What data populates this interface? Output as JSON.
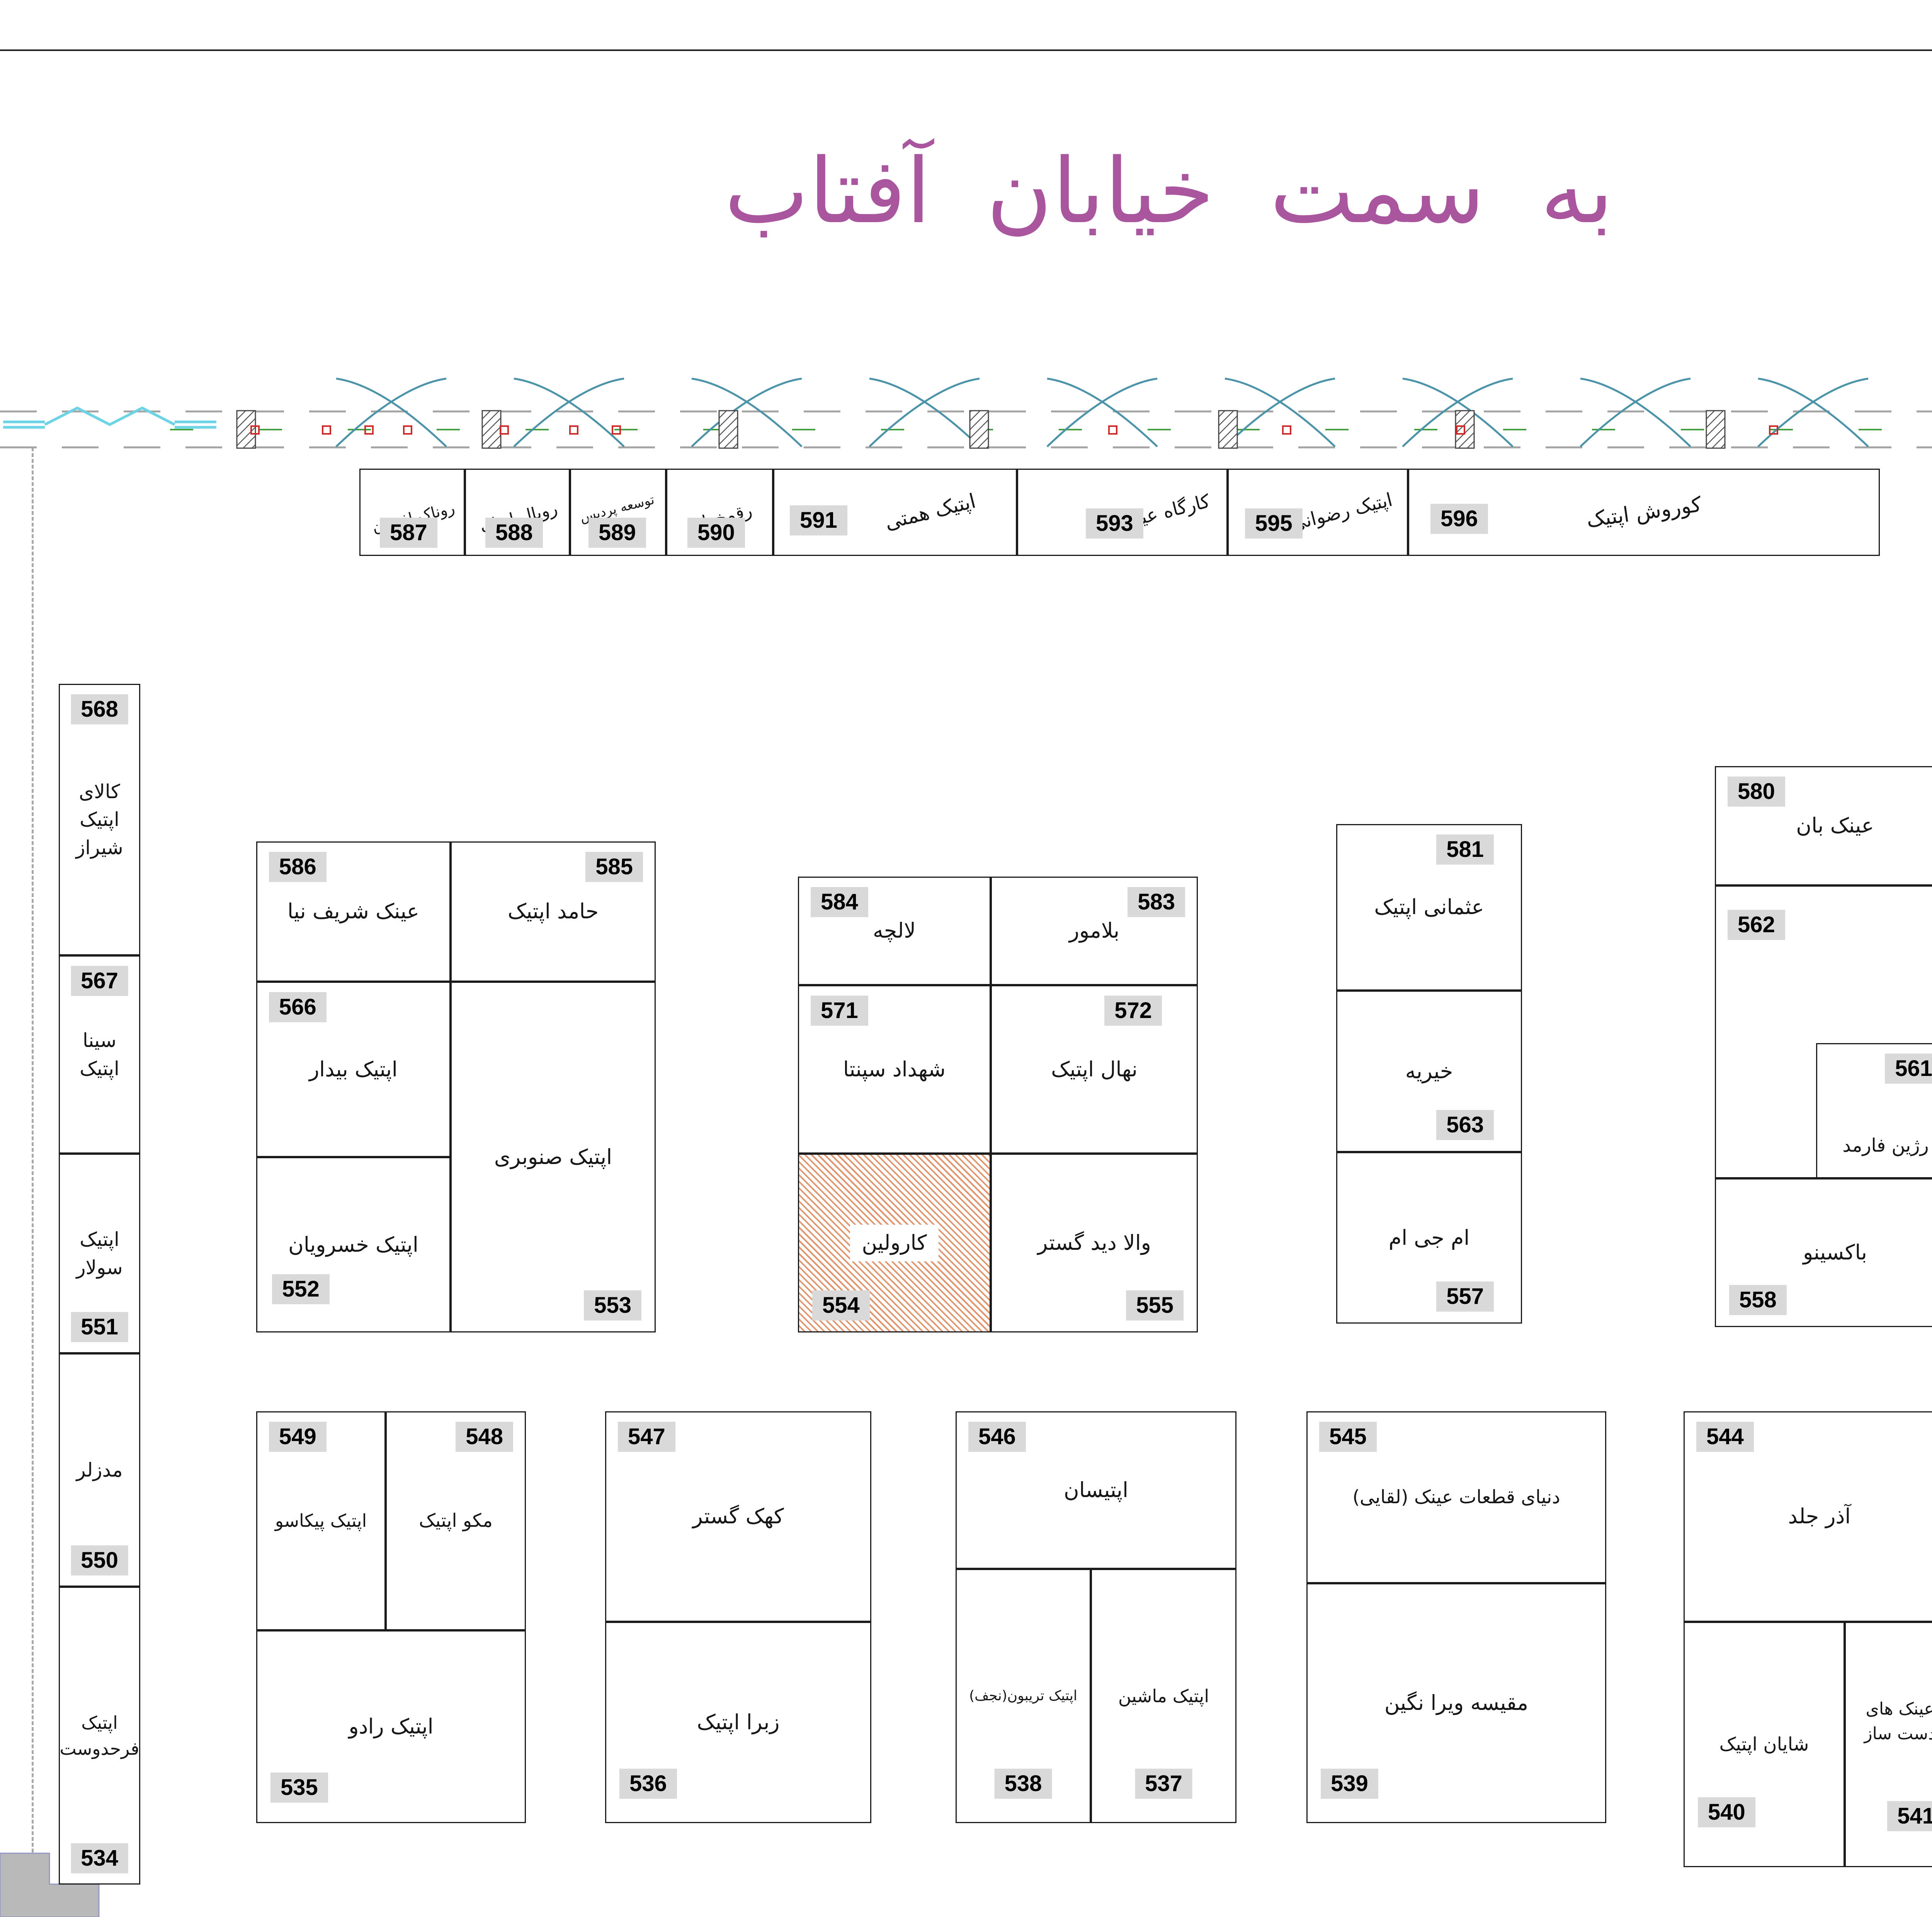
{
  "title": {
    "text": "به سمت خیابان آفتاب"
  },
  "markers": {
    "room_label": "5"
  },
  "colors": {
    "title_magenta": "#a9569f",
    "badge_bg": "#d9d9d9",
    "wall_gray": "#b9b9b9",
    "hatch_orange": "#e2946c",
    "teal": "#4b93a8",
    "cyan": "#6fd3e6",
    "maroon": "#8a3b3b",
    "tan": "#b7a46a",
    "green": "#2fae2f",
    "yellow": "#f0e000",
    "red": "#cf2a2a"
  },
  "units": {
    "u587": {
      "num": "587",
      "name": "روناک افشان"
    },
    "u588": {
      "num": "588",
      "name": "رویال اپتیک"
    },
    "u589": {
      "num": "589",
      "name": "توسعه پردیس ایما"
    },
    "u590": {
      "num": "590",
      "name": "رقمخوان"
    },
    "u591": {
      "num": "591",
      "name": "اپتیک همتی"
    },
    "u593": {
      "num": "593",
      "name": "کارگاه عینک"
    },
    "u595": {
      "num": "595",
      "name": "اپتیک رضوانی"
    },
    "u596": {
      "num": "596",
      "name": "کوروش اپتیک"
    },
    "u568": {
      "num": "568",
      "name": "کالای\nاپتیک\nشیراز"
    },
    "u567": {
      "num": "567",
      "name": "سینا\nاپتیک"
    },
    "u551": {
      "num": "551",
      "name": "اپتیک\nسولار"
    },
    "u550": {
      "num": "550",
      "name": "مدزلر"
    },
    "u534": {
      "num": "534",
      "name": "اپتیک\nفرحدوست"
    },
    "u586": {
      "num": "586",
      "name": "عینک شریف نیا"
    },
    "u585": {
      "num": "585",
      "name": "حامد اپتیک"
    },
    "u566": {
      "num": "566",
      "name": "اپتیک بیدار"
    },
    "u552": {
      "num": "552",
      "name": "اپتیک خسرویان"
    },
    "u553": {
      "num": "553",
      "name": "اپتیک صنوبری"
    },
    "u584": {
      "num": "584",
      "name": "لالچه"
    },
    "u583": {
      "num": "583",
      "name": "بلامور"
    },
    "u571": {
      "num": "571",
      "name": "شهداد سپنتا"
    },
    "u572": {
      "num": "572",
      "name": "نهال اپتیک"
    },
    "u554": {
      "num": "554",
      "name": "کارولین"
    },
    "u555": {
      "num": "555",
      "name": "والا دید گستر"
    },
    "u581": {
      "num": "581",
      "name": "عثمانی اپتیک"
    },
    "u563": {
      "num": "563",
      "name": "خیریه"
    },
    "u557": {
      "num": "557",
      "name": "ام جی ام"
    },
    "u580": {
      "num": "580",
      "name": "عینک بان"
    },
    "u562": {
      "num": "562",
      "name": "کافه"
    },
    "u561": {
      "num": "561",
      "name": "رژین فارمد"
    },
    "u558": {
      "num": "558",
      "name": "باکسینو"
    },
    "u597": {
      "num": "597",
      "name": "اپتیک\nزیلا"
    },
    "u579": {
      "num": "579",
      "name": "رایتل"
    },
    "u578": {
      "num": "578",
      "name": "گلدن سان"
    },
    "u577": {
      "num": "577",
      "name": "نارسیس"
    },
    "u575": {
      "num": "575",
      "name": "میز"
    },
    "u560": {
      "num": "560",
      "name": "مهران"
    },
    "u542": {
      "num": "542",
      "name": "تسلا\nاپتیک"
    },
    "u549": {
      "num": "549",
      "name": "اپتیک پیکاسو"
    },
    "u548": {
      "num": "548",
      "name": "مکو اپتیک"
    },
    "u535": {
      "num": "535",
      "name": "اپتیک رادو"
    },
    "u547": {
      "num": "547",
      "name": "کهک گستر"
    },
    "u536": {
      "num": "536",
      "name": "زبرا اپتیک"
    },
    "u546": {
      "num": "546",
      "name": "اپتیسان"
    },
    "u538": {
      "num": "538",
      "name": "اپتیک تریبون(نجف)"
    },
    "u537": {
      "num": "537",
      "name": "اپتیک ماشین"
    },
    "u545": {
      "num": "545",
      "name": "دنیای قطعات عینک (لقایی)"
    },
    "u539": {
      "num": "539",
      "name": "مقیسه ویرا نگین"
    },
    "u544": {
      "num": "544",
      "name": "آذر جلد"
    },
    "u540": {
      "num": "540",
      "name": "شایان اپتیک"
    },
    "u541": {
      "num": "541",
      "name": "عینک های\nدست ساز"
    }
  }
}
